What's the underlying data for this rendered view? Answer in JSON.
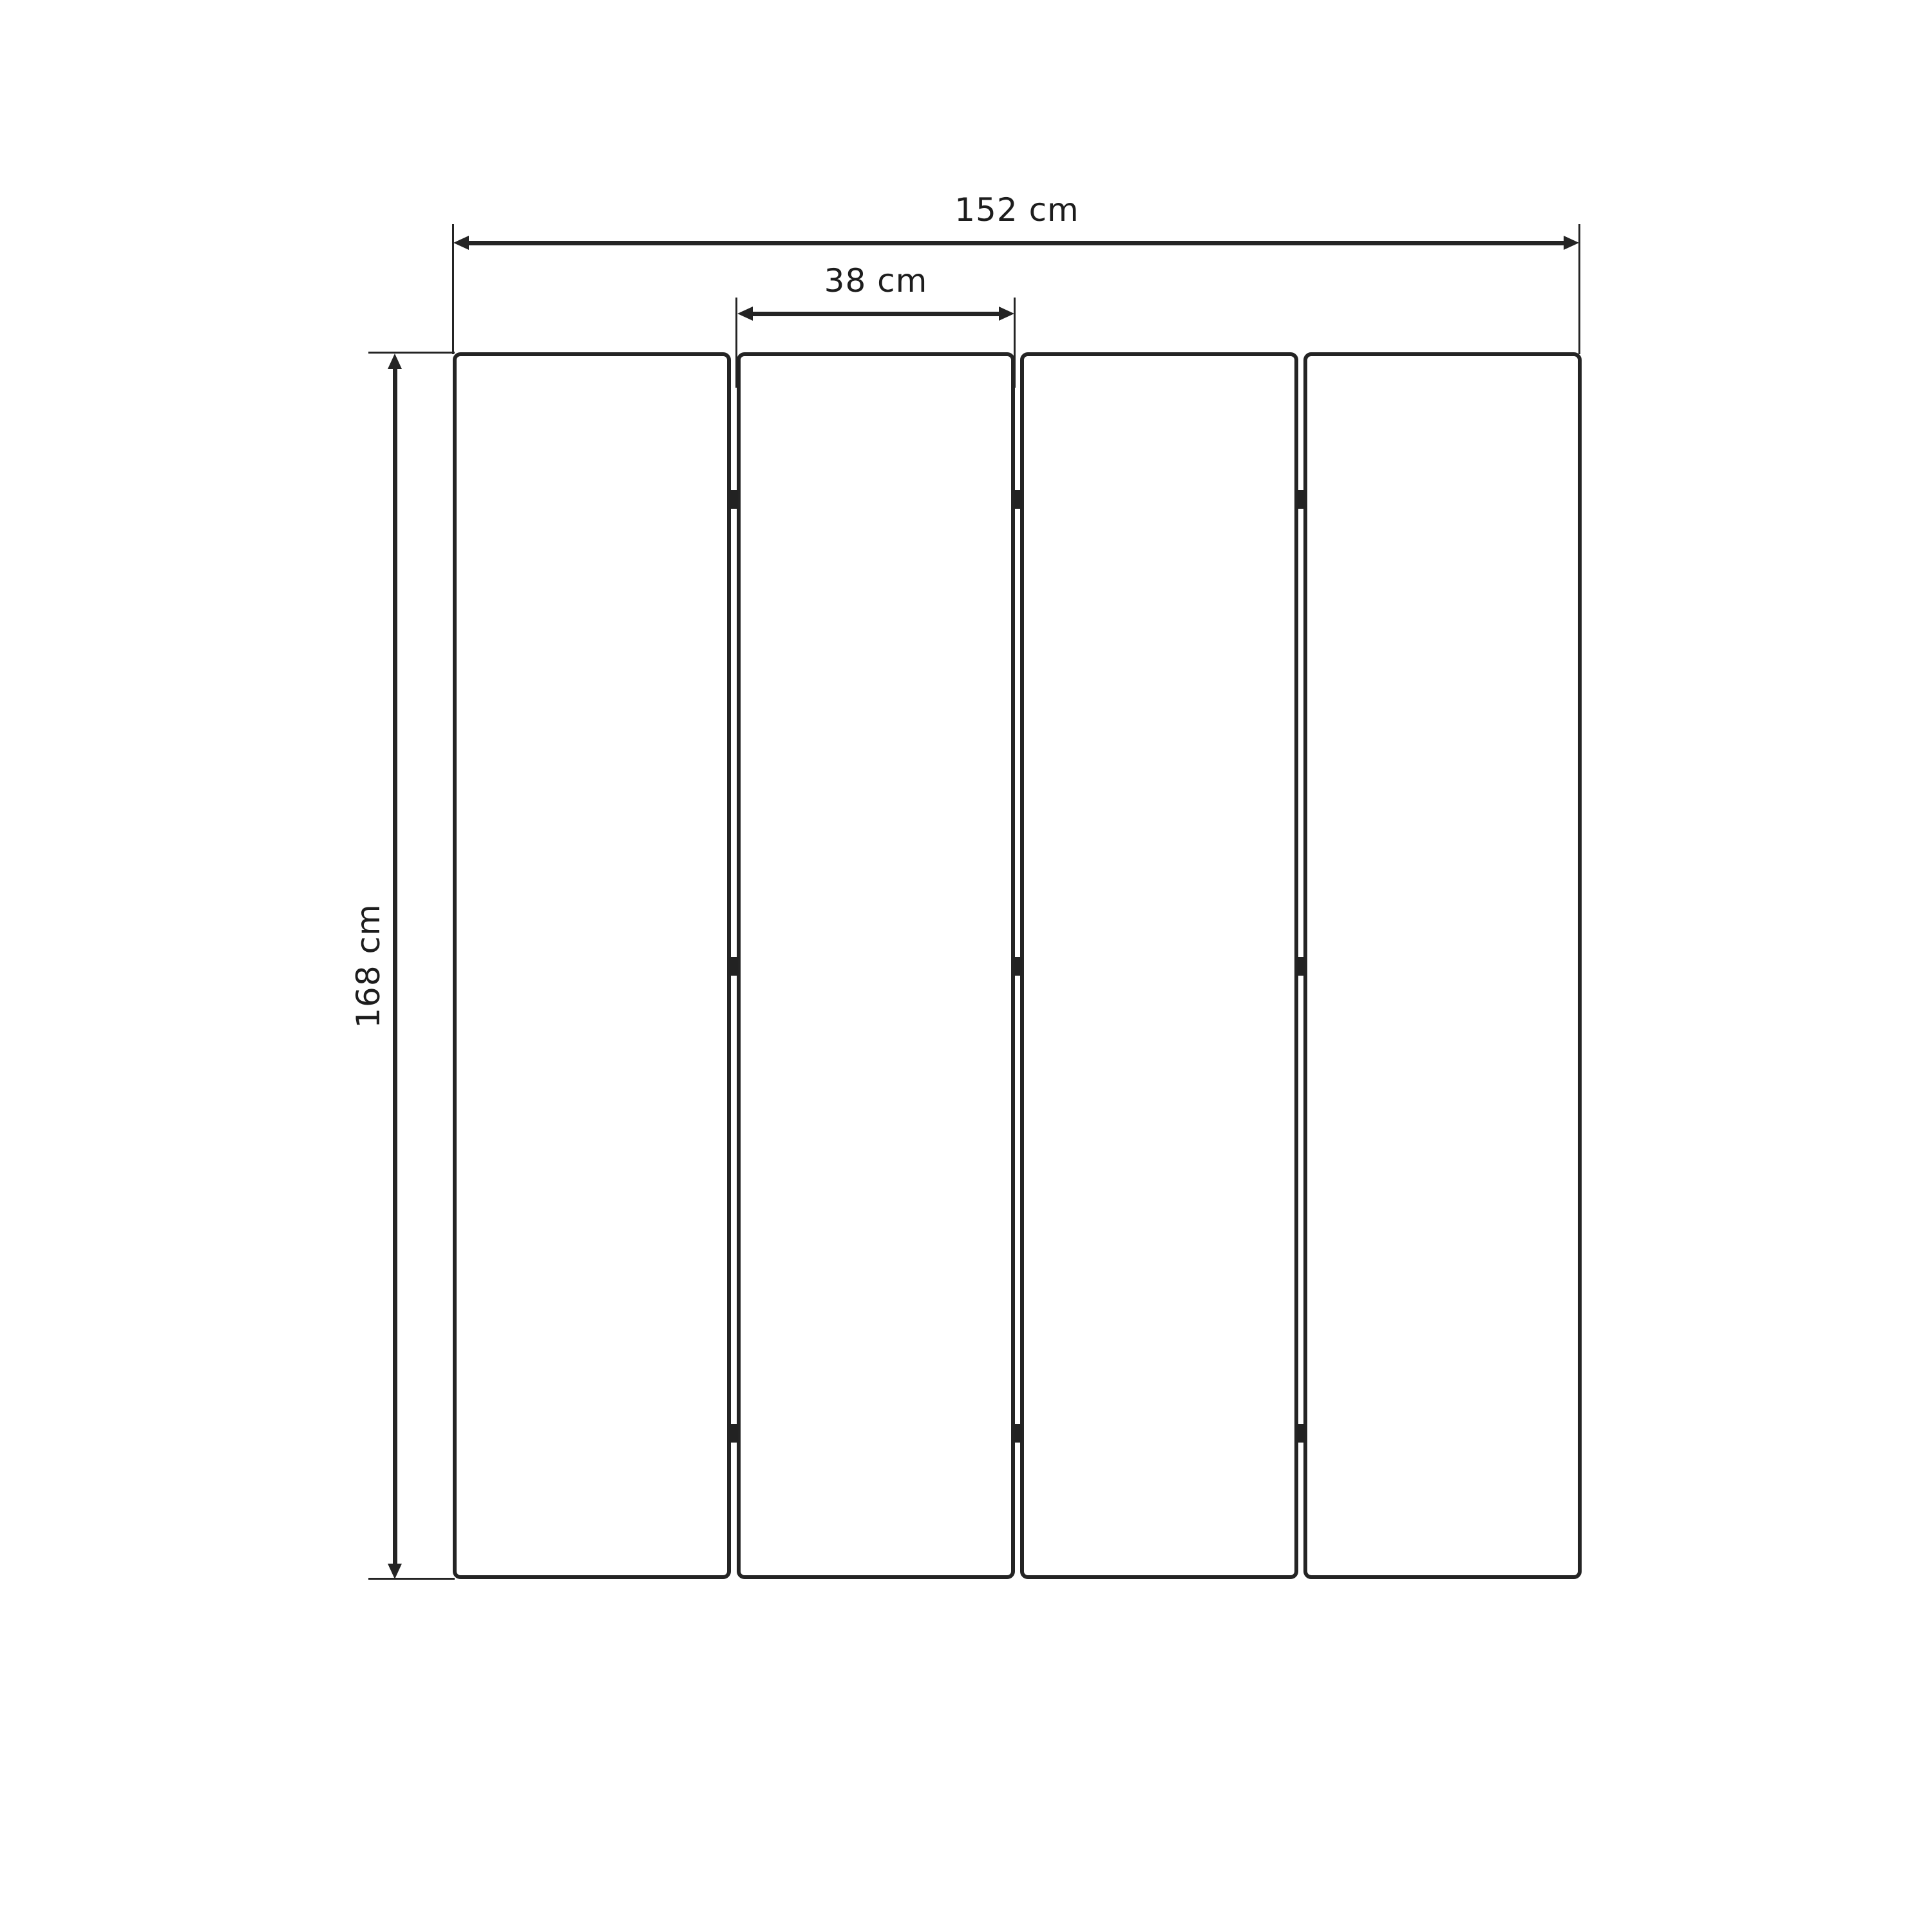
{
  "drawing": {
    "subject": "4-panel folding screen room divider - front elevation with dimensions",
    "unit": "cm",
    "panel_count": 4,
    "hinge_marks_per_joint": 3,
    "values": {
      "total_width_cm": 152,
      "panel_width_cm": 38,
      "height_cm": 168
    },
    "dimensions": {
      "total_width": {
        "label": "152 cm",
        "orientation": "horizontal"
      },
      "panel_width": {
        "label": "38 cm",
        "orientation": "horizontal"
      },
      "height": {
        "label": "168 cm",
        "orientation": "vertical"
      }
    },
    "colors": {
      "line": "#242424",
      "hinge": "#222222",
      "panel_fill": "#ffffff",
      "background": "#ffffff"
    }
  }
}
